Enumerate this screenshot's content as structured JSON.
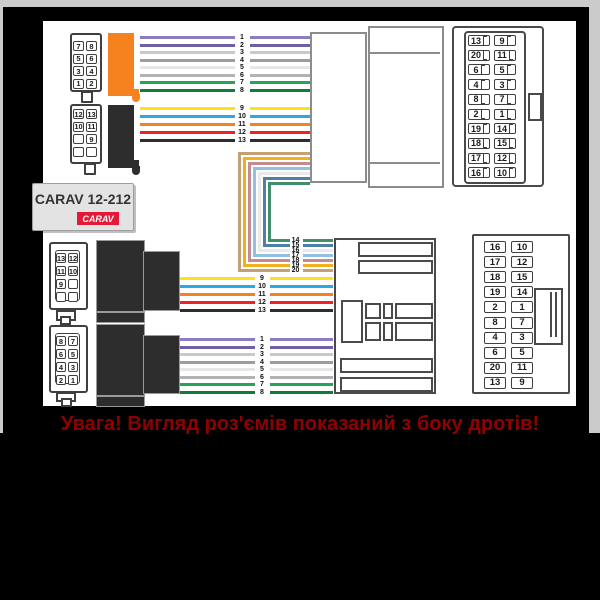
{
  "product": {
    "title": "CARAV 12-212",
    "brand_badge": "CARAV"
  },
  "warning_text": "Увага! Вигляд роз'ємів показаний з боку дротів!",
  "accent_colors": {
    "orange_connector": "#F6821F",
    "black_connector": "#2d2d2d",
    "badge_red": "#E51937",
    "warning_red": "#8F0000",
    "panel_white": "#ffffff",
    "frame_gray": "#cbcbcb"
  },
  "wire_palette": {
    "1": "#8E7CC3",
    "2": "#6E5FA6",
    "3": "#C9C9C9",
    "4": "#9D9D9D",
    "5": "#E6E6E6",
    "6": "#B3B3B3",
    "7": "#27A457",
    "8": "#0F7B3C",
    "9": "#FFE019",
    "10": "#2BA9E0",
    "11": "#F58220",
    "12": "#EC2227",
    "13": "#2D2D2D",
    "14": "#3F8F6F",
    "15": "#4E80A6",
    "16": "#E9E9E9",
    "17": "#93C1DD",
    "18": "#C48D8D",
    "19": "#F2AF1D",
    "20": "#C5A075"
  },
  "wire_groups": {
    "upper_1_8": [
      1,
      2,
      3,
      4,
      5,
      6,
      7,
      8
    ],
    "upper_9_13": [
      9,
      10,
      11,
      12,
      13
    ],
    "loop_14_20": [
      14,
      15,
      16,
      17,
      18,
      19,
      20
    ],
    "lower_9_13": [
      9,
      10,
      11,
      12,
      13
    ],
    "lower_1_8": [
      1,
      2,
      3,
      4,
      5,
      6,
      7,
      8
    ]
  },
  "connectors": {
    "top_left_8pin": {
      "rows": [
        [
          "7",
          "8"
        ],
        [
          "5",
          "6"
        ],
        [
          "3",
          "4"
        ],
        [
          "1",
          "2"
        ]
      ]
    },
    "top_left_10pin": {
      "rows": [
        [
          "12",
          "13"
        ],
        [
          "10",
          "11"
        ],
        [
          "",
          "9"
        ],
        [
          "",
          ""
        ]
      ]
    },
    "bottom_left_10pin": {
      "rows": [
        [
          "13",
          "12"
        ],
        [
          "11",
          "10"
        ],
        [
          "9",
          ""
        ],
        [
          "",
          ""
        ]
      ]
    },
    "bottom_left_8pin": {
      "rows": [
        [
          "8",
          "7"
        ],
        [
          "6",
          "5"
        ],
        [
          "4",
          "3"
        ],
        [
          "2",
          "1"
        ]
      ]
    },
    "top_right_20pin": {
      "rows": [
        [
          "13",
          "9"
        ],
        [
          "20",
          "11"
        ],
        [
          "6",
          "5"
        ],
        [
          "4",
          "3"
        ],
        [
          "8",
          "7"
        ],
        [
          "2",
          "1"
        ],
        [
          "19",
          "14"
        ],
        [
          "18",
          "15"
        ],
        [
          "17",
          "12"
        ],
        [
          "16",
          "10"
        ]
      ]
    },
    "bottom_right_20pin": {
      "rows": [
        [
          "16",
          "10"
        ],
        [
          "17",
          "12"
        ],
        [
          "18",
          "15"
        ],
        [
          "19",
          "14"
        ],
        [
          "2",
          "1"
        ],
        [
          "8",
          "7"
        ],
        [
          "4",
          "3"
        ],
        [
          "6",
          "5"
        ],
        [
          "20",
          "11"
        ],
        [
          "13",
          "9"
        ]
      ]
    }
  }
}
